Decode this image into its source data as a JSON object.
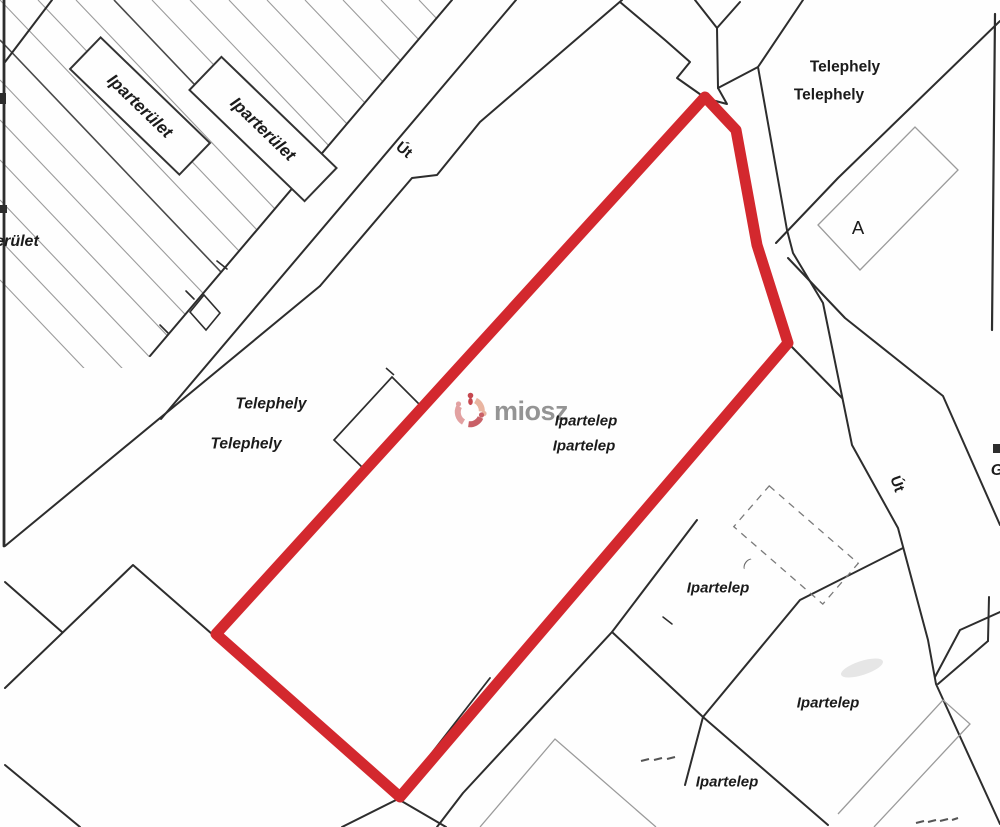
{
  "map": {
    "title": "cadastral parcel map",
    "colors": {
      "highlight_red": "#d3282e",
      "boundary_line": "#2d2d2d",
      "light_parcel_line": "#9b9b9b",
      "watermark_gray": "#8d8d8d",
      "logo_pink": "#e09a9b",
      "logo_peach": "#e8b09b",
      "logo_red": "#c6555c"
    },
    "labels": {
      "erulet_partial": "erület",
      "iparterulet_1": "Iparterület",
      "iparterulet_2": "Iparterület",
      "ut_top": "Út",
      "telephely_top_1": "Telephely",
      "telephely_top_2": "Telephely",
      "parcel_a": "A",
      "g_partial": "G",
      "ut_right": "Út",
      "telephely_mid_1": "Telephely",
      "telephely_mid_2": "Telephely",
      "ipartelep_1": "Ipartelep",
      "ipartelep_2": "Ipartelep",
      "ipartelep_3": "Ipartelep",
      "ipartelep_4": "Ipartelep",
      "ipartelep_5": "Ipartelep",
      "paren_mark": "("
    },
    "watermark": {
      "brand": "miosz"
    }
  }
}
